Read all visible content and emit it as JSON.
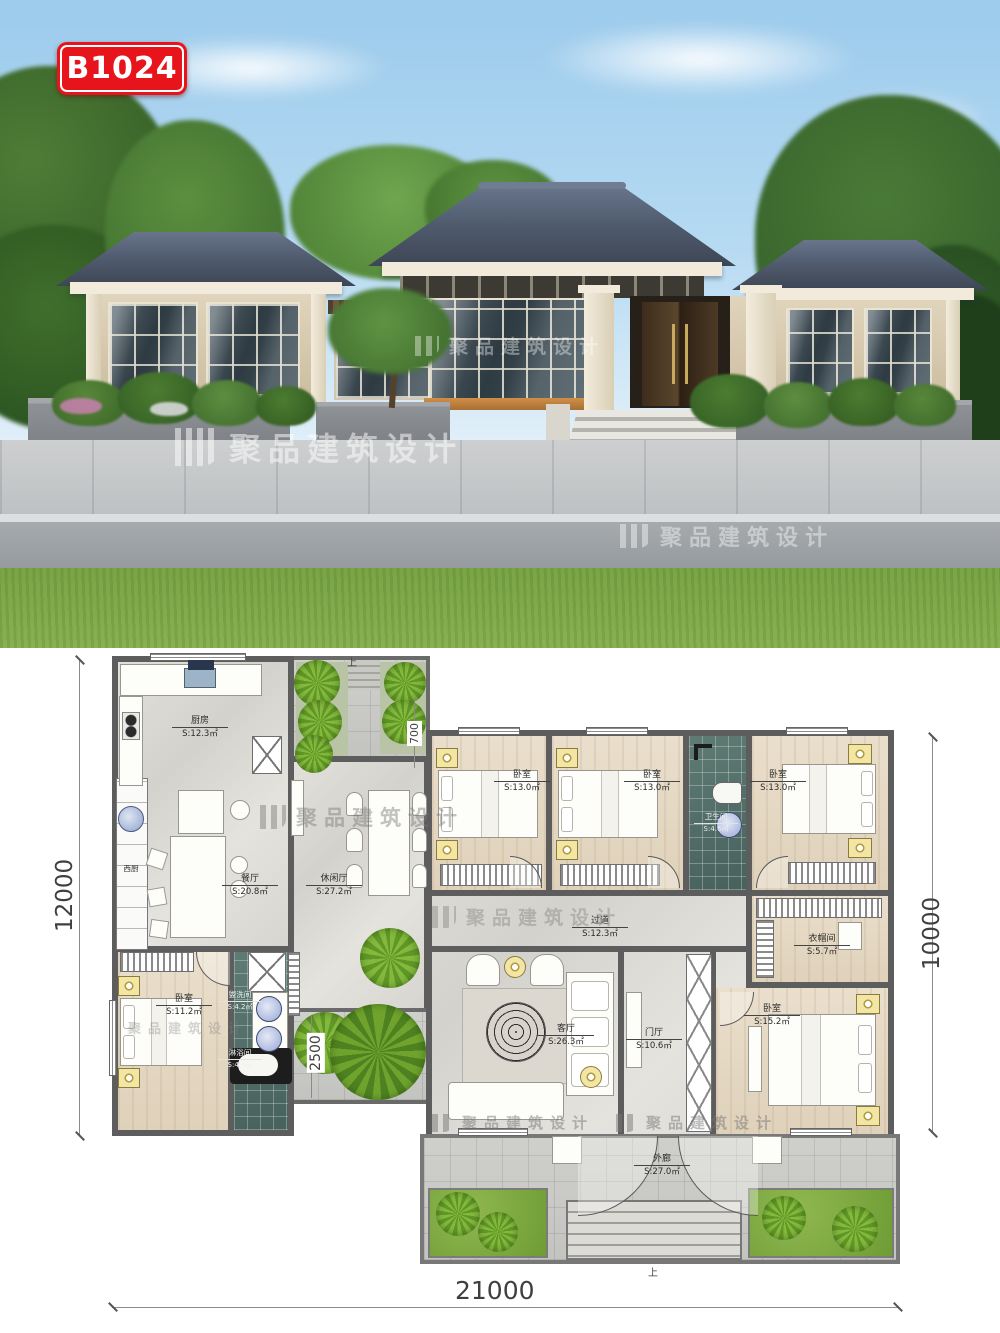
{
  "badge": {
    "code": "B1024"
  },
  "watermark": {
    "text": "聚品建筑设计"
  },
  "plan": {
    "rooms": {
      "kitchen": {
        "name": "厨房",
        "area": "S:12.3㎡"
      },
      "dining": {
        "name": "餐厅",
        "area": "S:20.8㎡"
      },
      "west_kitchen": {
        "name": "西厨",
        "area": ""
      },
      "leisure": {
        "name": "休闲厅",
        "area": "S:27.2㎡"
      },
      "bedroom1": {
        "name": "卧室",
        "area": "S:13.0㎡"
      },
      "bedroom2": {
        "name": "卧室",
        "area": "S:13.0㎡"
      },
      "bath": {
        "name": "卫生间",
        "area": "S:4.6㎡"
      },
      "bedroom3": {
        "name": "卧室",
        "area": "S:13.0㎡"
      },
      "hallway": {
        "name": "过道",
        "area": "S:12.3㎡"
      },
      "closet": {
        "name": "衣帽间",
        "area": "S:5.7㎡"
      },
      "living": {
        "name": "客厅",
        "area": "S:26.3㎡"
      },
      "foyer": {
        "name": "门厅",
        "area": "S:10.6㎡"
      },
      "master": {
        "name": "卧室",
        "area": "S:15.2㎡"
      },
      "bedroom4": {
        "name": "卧室",
        "area": "S:11.2㎡"
      },
      "washroom": {
        "name": "盥洗间",
        "area": "S:4.2㎡"
      },
      "shower": {
        "name": "淋浴间",
        "area": "S:4.0㎡"
      },
      "porch": {
        "name": "外廊",
        "area": "S:27.0㎡"
      }
    },
    "dimensions": {
      "left": "12000",
      "right": "10000",
      "bottom": "21000",
      "courtyard": "2500",
      "garden": "700"
    },
    "stair_up": "上"
  }
}
